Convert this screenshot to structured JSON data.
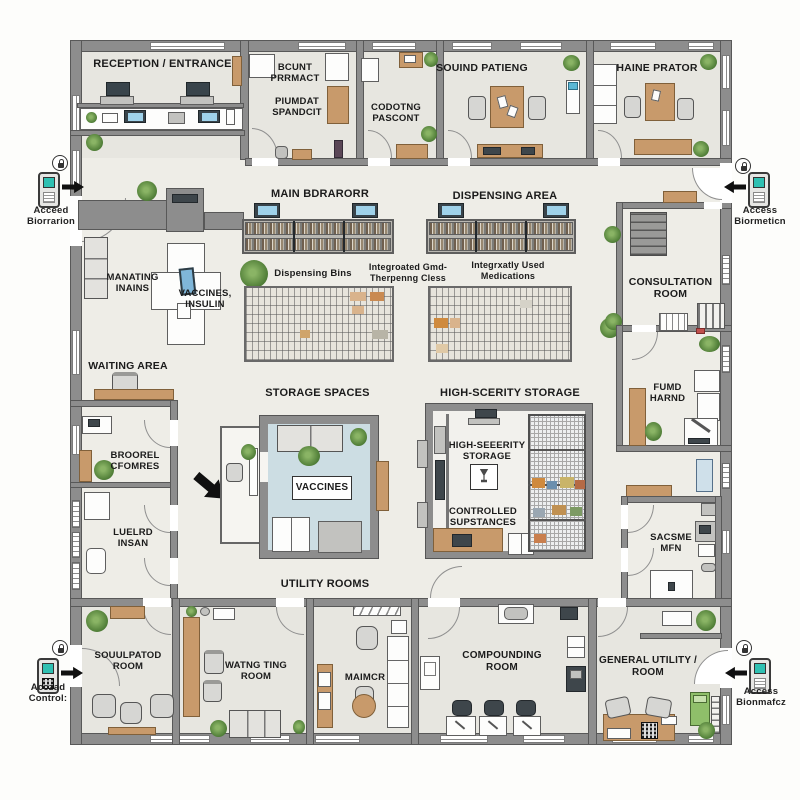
{
  "rooms": {
    "reception": "RECEPTION / ENTRANCE",
    "pharmacy_office_a": "BCUNT\nPRRMACT",
    "pharmacy_office_b": "PIUMDAT\nSPANDCIT",
    "coding_room": "CODOTNG\nPASCONT",
    "sound_patient_room": "SOUIND PATIENG",
    "haine_prator_room": "HAINE PRATOR",
    "manating_inains": "MANATING\nINAINS",
    "waiting_area": "WAITING AREA",
    "broorel_cfomres": "BROOREL\nCFOMRES",
    "luelrd_insan": "LUELRD\nINSAN",
    "consultation": "CONSULTATION\nROOM",
    "fumd_harnd": "FUMD\nHARND",
    "sacsme_mfn": "SACSME\nMFN",
    "soulpatod": "SOUULPATOD\nROOM",
    "watng_ting": "WATNG TING\nROOM",
    "maimcr": "MAIMCR",
    "compounding": "COMPOUNDING\nROOM",
    "general_utility": "GENERAL UTILITY /\nROOM"
  },
  "areas": {
    "main_corridor": "MAIN BDRARORR",
    "dispensing_area": "DISPENSING AREA",
    "storage_spaces": "STORAGE SPACES",
    "high_security_storage": "HIGH-SCERITY STORAGE",
    "utility_rooms": "UTILITY ROOMS"
  },
  "storage_labels": {
    "dispensing_bins": "Dispensing Bins",
    "integrated_class": "Integroated Gmd-\nTherpenng Cless",
    "frequently_used": "Integrxatly Used\nMedications",
    "vaccines_insulin": "VACCINES,\nINSULIN",
    "vaccines_box": "VACCINES",
    "high_security_inner": "HIGH-SEEERITY\nSTORAGE",
    "controlled_substances": "CONTROLLED\nSUPSTANCES"
  },
  "annotations": {
    "access_top_left": "Acceed\nBiorrarion",
    "access_top_right": "Access\nBiormeticn",
    "access_bottom_left": "Acczad\nControl:",
    "access_bottom_right": "Access\nBionmafcz"
  },
  "colors": {
    "wall": "#8d8d8d",
    "wall_outline": "#585858",
    "floor": "#eeede7",
    "room_floor": "#e7e6e0",
    "wood": "#c89a6b",
    "vaccine_room_floor": "#ccdde3",
    "device_screen_teal": "#2fc0b2",
    "monitor_screen_blue": "#9fd2ea",
    "plant_green": "#4e7c36",
    "arrow_black": "#101010"
  }
}
